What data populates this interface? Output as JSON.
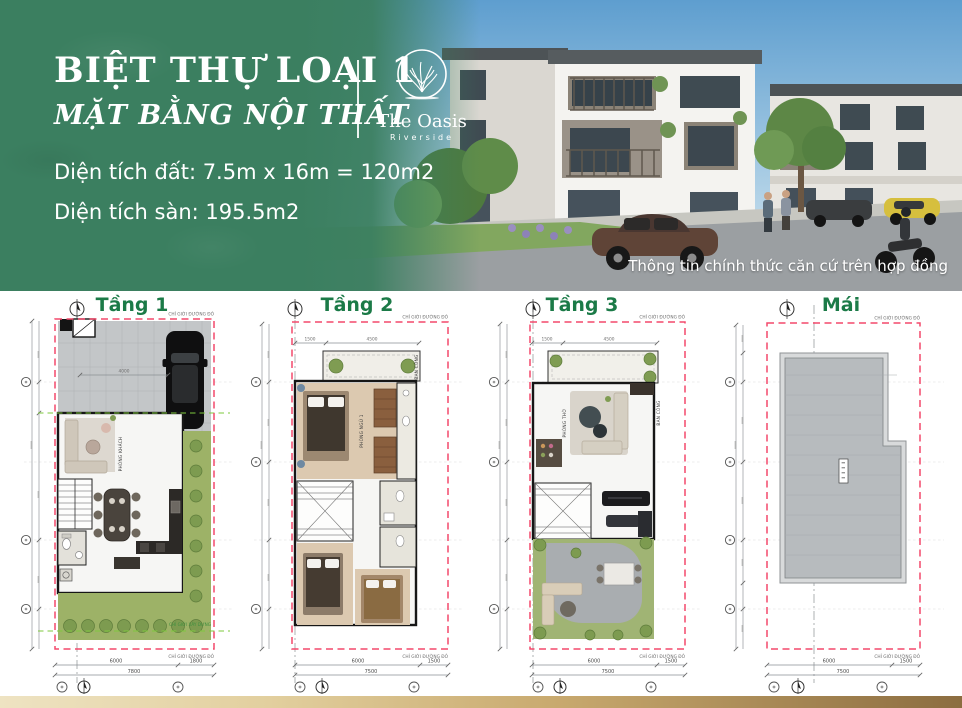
{
  "header": {
    "title": "BIỆT THỰ LOẠI 1",
    "subtitle": "MẶT BẰNG NỘI THẤT",
    "brand": {
      "name": "The Oasis",
      "tagline": "Riverside"
    },
    "land_area": "Diện tích đất: 7.5m x 16m = 120m2",
    "floor_area": "Diện tích sàn: 195.5m2",
    "disclaimer": "Thông tin chính thức căn cứ trên hợp đồng"
  },
  "colors": {
    "brand_green": "#3B7F60",
    "plan_title_green": "#1B7A47",
    "boundary_red": "#F4496B",
    "setback_green": "#7EC83E",
    "footer_gold_light": "#EEE3C2",
    "footer_gold_dark": "#8C6D40"
  },
  "plans": [
    {
      "id": "tang-1",
      "title": "Tầng 1",
      "labels": {
        "boundary": "CHỈ GIỚI ĐƯỜNG ĐỎ",
        "build": "CHỈ GIỚI XÂY DỰNG"
      },
      "rooms": [
        "PHÒNG KHÁCH"
      ],
      "dims": {
        "top": "4000",
        "bottom": [
          "6000",
          "1800"
        ],
        "total": "7800"
      }
    },
    {
      "id": "tang-2",
      "title": "Tầng 2",
      "labels": {
        "boundary": "CHỈ GIỚI ĐƯỜNG ĐỎ"
      },
      "rooms": [
        "PHÒNG NGỦ 1",
        "BAN CÔNG"
      ],
      "dims": {
        "top": [
          "1500",
          "4500"
        ],
        "bottom": [
          "6000",
          "1500"
        ],
        "total": "7500"
      }
    },
    {
      "id": "tang-3",
      "title": "Tầng 3",
      "labels": {
        "boundary": "CHỈ GIỚI ĐƯỜNG ĐỎ"
      },
      "rooms": [
        "PHÒNG THỜ",
        "BAN CÔNG"
      ],
      "dims": {
        "top": [
          "1500",
          "4500"
        ],
        "bottom": [
          "6000",
          "1500"
        ],
        "total": "7500"
      }
    },
    {
      "id": "mai",
      "title": "Mái",
      "labels": {
        "boundary": "CHỈ GIỚI ĐƯỜNG ĐỎ"
      },
      "dims": {
        "bottom": [
          "6000",
          "1500"
        ],
        "total": "7500"
      }
    }
  ]
}
